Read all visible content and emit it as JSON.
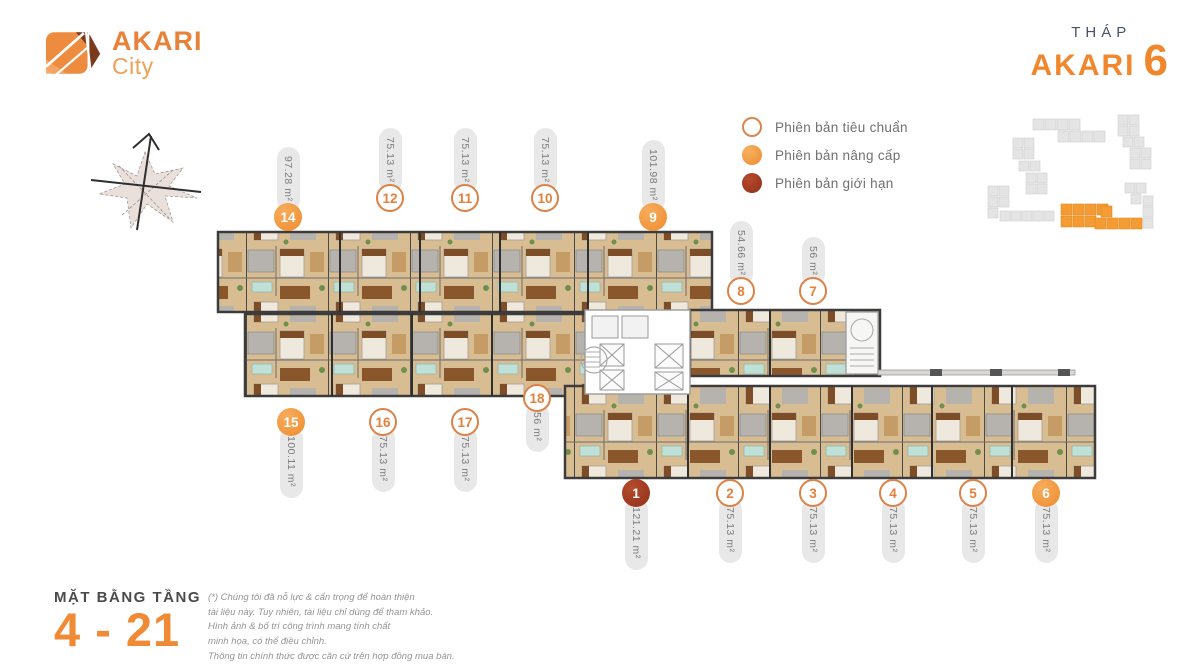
{
  "logo": {
    "name": "AKARI",
    "sub": "City"
  },
  "tower": {
    "label": "THÁP",
    "name": "AKARI",
    "number": "6"
  },
  "legend": {
    "items": [
      {
        "label": "Phiên bản tiêu chuẩn",
        "type": "standard"
      },
      {
        "label": "Phiên bản nâng cấp",
        "type": "upgrade"
      },
      {
        "label": "Phiên bản giới hạn",
        "type": "limited"
      }
    ]
  },
  "floor": {
    "label": "MẶT BẰNG TẦNG",
    "range": "4 - 21"
  },
  "disclaimer": {
    "lines": [
      "(*) Chúng tôi đã nỗ lực & cẩn trọng để hoàn thiện",
      "tài liệu này. Tuy nhiên, tài liệu chỉ dùng để tham khảo.",
      "Hình ảnh & bố trí công trình mang tính chất",
      "minh họa, có thể điều chỉnh.",
      "Thông tin chính thức được căn cứ trên hợp đồng mua bán."
    ]
  },
  "units": [
    {
      "number": "14",
      "area": "97.28 m²",
      "type": "upgrade",
      "variant": "above",
      "x": 288,
      "badge_y": 217
    },
    {
      "number": "12",
      "area": "75.13 m²",
      "type": "standard",
      "variant": "above",
      "x": 390,
      "badge_y": 198
    },
    {
      "number": "11",
      "area": "75.13 m²",
      "type": "standard",
      "variant": "above",
      "x": 465,
      "badge_y": 198
    },
    {
      "number": "10",
      "area": "75.13 m²",
      "type": "standard",
      "variant": "above",
      "x": 545,
      "badge_y": 198
    },
    {
      "number": "9",
      "area": "101.98 m²",
      "type": "upgrade",
      "variant": "above",
      "x": 653,
      "badge_y": 217
    },
    {
      "number": "8",
      "area": "54.66 m²",
      "type": "standard",
      "variant": "above",
      "x": 741,
      "badge_y": 291
    },
    {
      "number": "7",
      "area": "56 m²",
      "type": "standard",
      "variant": "above",
      "x": 813,
      "badge_y": 291
    },
    {
      "number": "15",
      "area": "100.11 m²",
      "type": "upgrade",
      "variant": "below",
      "x": 291,
      "badge_y": 422
    },
    {
      "number": "16",
      "area": "75.13 m²",
      "type": "standard",
      "variant": "below",
      "x": 383,
      "badge_y": 422
    },
    {
      "number": "17",
      "area": "75.13 m²",
      "type": "standard",
      "variant": "below",
      "x": 465,
      "badge_y": 422
    },
    {
      "number": "18",
      "area": "56 m²",
      "type": "standard",
      "variant": "below",
      "x": 537,
      "badge_y": 398
    },
    {
      "number": "1",
      "area": "121.21 m²",
      "type": "limited",
      "variant": "below",
      "x": 636,
      "badge_y": 493
    },
    {
      "number": "2",
      "area": "75.13 m²",
      "type": "standard",
      "variant": "below",
      "x": 730,
      "badge_y": 493
    },
    {
      "number": "3",
      "area": "75.13 m²",
      "type": "standard",
      "variant": "below",
      "x": 813,
      "badge_y": 493
    },
    {
      "number": "4",
      "area": "75.13 m²",
      "type": "standard",
      "variant": "below",
      "x": 893,
      "badge_y": 493
    },
    {
      "number": "5",
      "area": "75.13 m²",
      "type": "standard",
      "variant": "below",
      "x": 973,
      "badge_y": 493
    },
    {
      "number": "6",
      "area": "75.13 m²",
      "type": "upgrade",
      "variant": "below",
      "x": 1046,
      "badge_y": 493
    }
  ],
  "colors": {
    "accent": "#F18A35",
    "upgrade_fill": "#F0923F",
    "limited_fill": "#A53D22",
    "standard_border": "#DB8246",
    "pill_bg": "#E8E8E8",
    "legend_text": "#707070",
    "thap_text": "#46536B"
  }
}
